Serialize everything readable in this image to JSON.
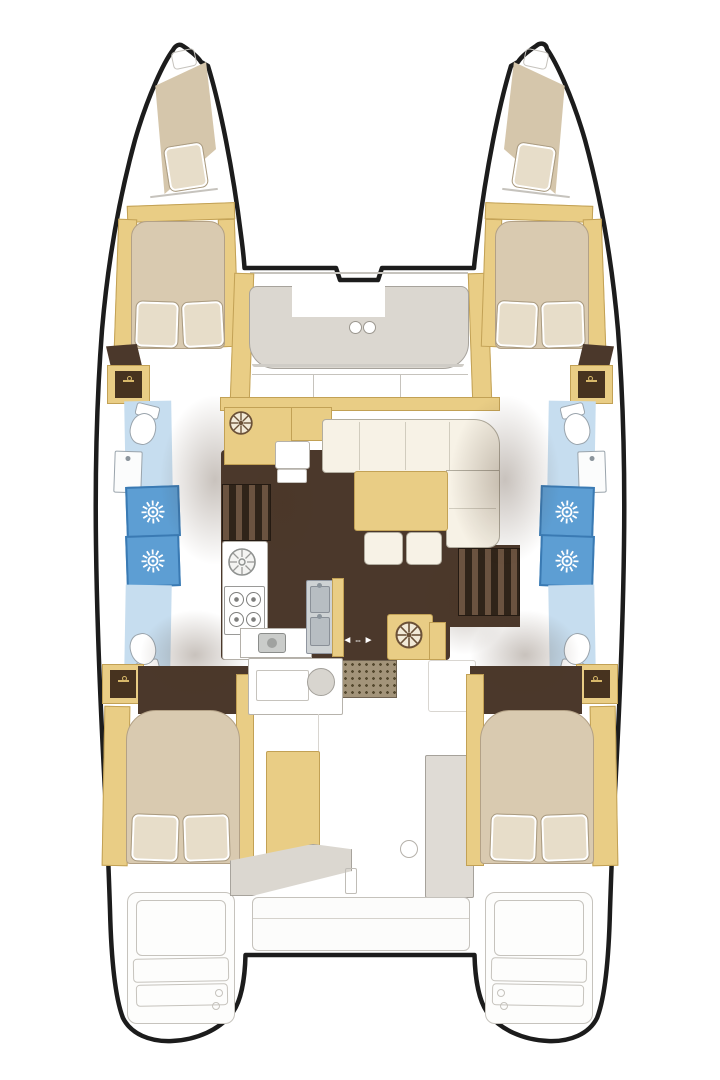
{
  "sliding_door": {
    "left_arrow": "◄",
    "gap": "--",
    "right_arrow": "►"
  },
  "colors": {
    "hull_outline": "#1c1c1c",
    "wood": "#e9cd85",
    "wood_border": "#c2a155",
    "floor_dark": "#4b382b",
    "stair_dark": "#302419",
    "stair_light": "#6b5340",
    "bed": "#d9cab0",
    "bed_border": "#b3a186",
    "pillow": "#e7ddc9",
    "sofa_cream": "#f7f2e6",
    "sofa_border": "#b2ad9f",
    "seat_gray": "#dbd7d0",
    "seat_gray_border": "#a7a39c",
    "line_gray": "#c6c3bd",
    "bath_floor_blue": "#c6ddef",
    "shower_tile_blue": "#5d9ed3",
    "shower_tile_border": "#3a7ab3",
    "fixture_white": "#fbfcfc",
    "fixture_border": "#9aa4ac",
    "grate": "#a3947a",
    "shadow": "rgba(74,53,35,0.30)"
  },
  "icons": [
    "shower-head-icon",
    "clothes-hanger-icon",
    "helm-wheel-icon",
    "stove-burner-icon",
    "round-sink-icon",
    "double-sink-icon",
    "toilet-icon",
    "cup-holder-icon",
    "sliding-door-arrow-icon"
  ]
}
